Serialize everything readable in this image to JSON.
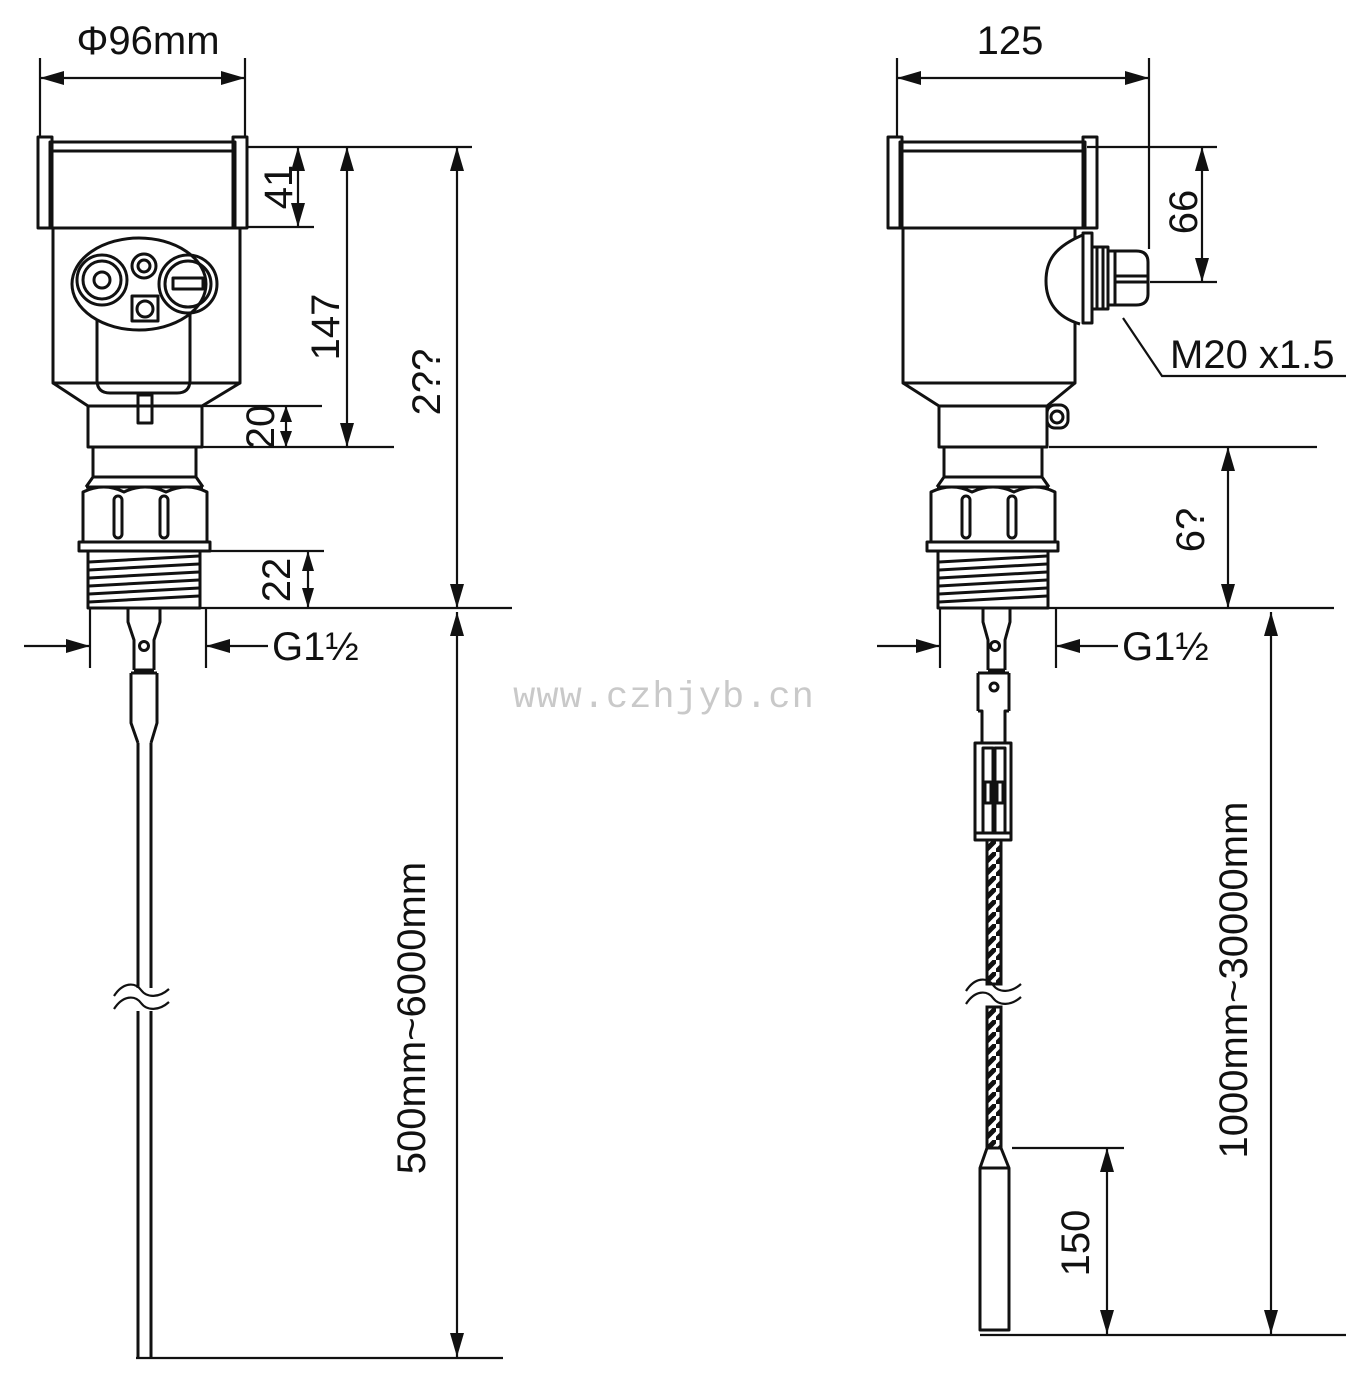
{
  "watermark": "www.czhjyb.cn",
  "left_view": {
    "dia_width": "Φ96mm",
    "cap_height": "41",
    "head_height": "147",
    "overall_height": "2??",
    "neck_height": "20",
    "thread_length": "22",
    "process_thread": "G1½",
    "probe_length_range": "500mm~6000mm"
  },
  "right_view": {
    "overall_width": "125",
    "gland_height": "66",
    "cable_gland_thread": "M20 x1.5",
    "adapter_height": "6?",
    "process_thread": "G1½",
    "cable_length_range": "1000mm~30000mm",
    "weight_length": "150"
  }
}
